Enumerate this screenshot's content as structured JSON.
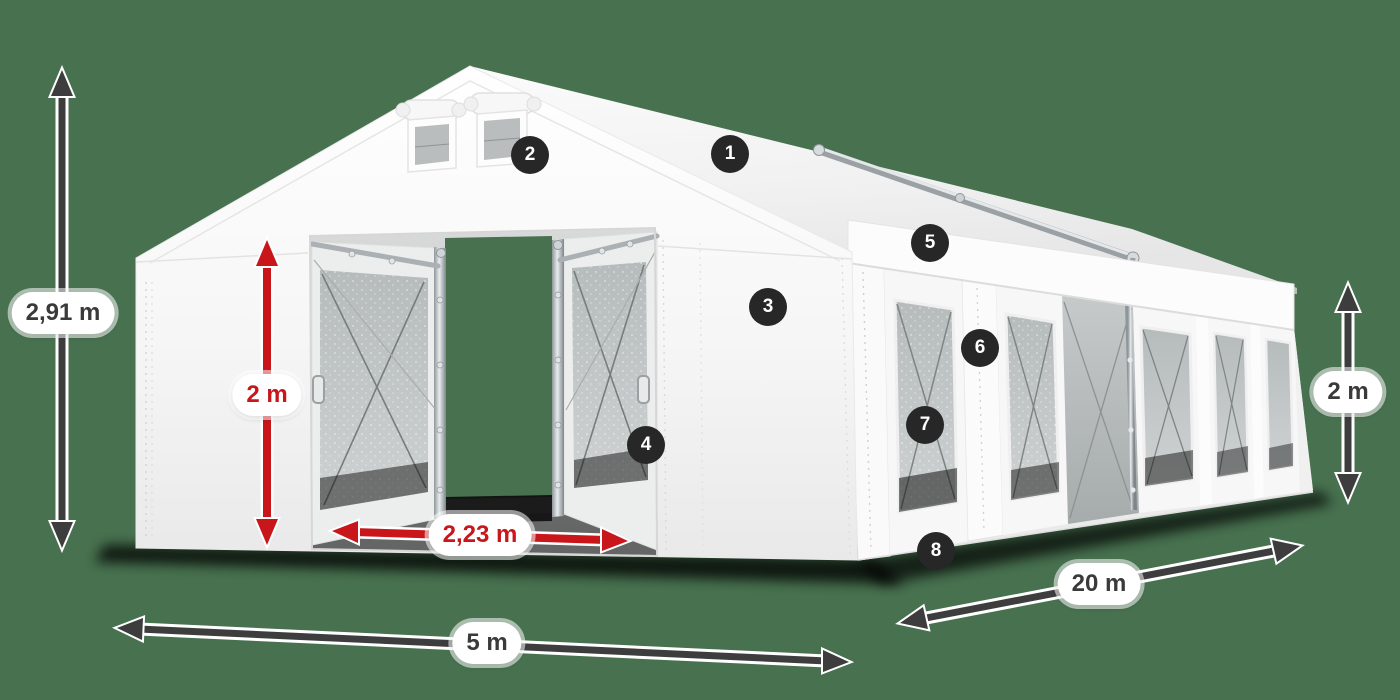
{
  "scene": {
    "description": "Dimension diagram of a white 5x20 m marquee tent with open sliding front doors, side windows and numbered feature markers",
    "colors": {
      "background": "#47714F",
      "dimension_red": "#C8161A",
      "dimension_dark": "#3D3D3D",
      "marker_bg": "#272727",
      "label_text": "#3A3A3A",
      "tent_white": "#F7F7F7"
    },
    "dimension_labels": {
      "total_height": "2,91 m",
      "door_height": "2 m",
      "door_width": "2,23 m",
      "front_width": "5 m",
      "side_length": "20 m",
      "wall_height": "2 m"
    },
    "feature_markers": [
      {
        "number": "1"
      },
      {
        "number": "2"
      },
      {
        "number": "3"
      },
      {
        "number": "4"
      },
      {
        "number": "5"
      },
      {
        "number": "6"
      },
      {
        "number": "7"
      },
      {
        "number": "8"
      }
    ]
  }
}
